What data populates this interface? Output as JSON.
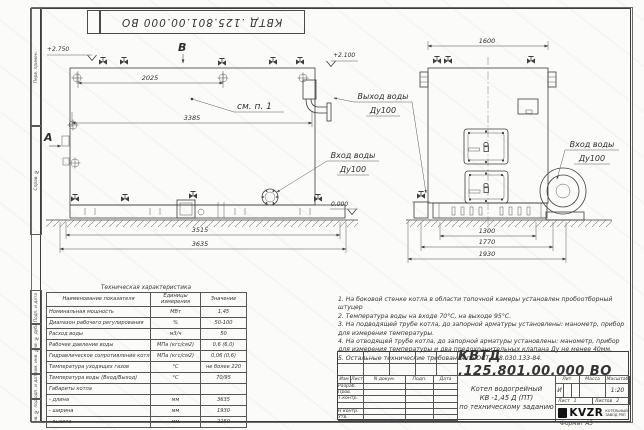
{
  "colors": {
    "line": "#3d3d3d",
    "paper": "#fbfbf9"
  },
  "stamp": {
    "doc_number_rotated": "КВТД .125.801.00.000  ВО"
  },
  "frame": {
    "side_labels": [
      "Перв. примен.",
      "Справ. №",
      "Подп. и дата",
      "Инв. № дубл.",
      "Взам. инв. №",
      "Подп. и дата",
      "Инв. № подл."
    ],
    "format_note": "Формат   А3"
  },
  "drawing": {
    "dims": {
      "top_left": "2025",
      "body_left": "3385",
      "base_left": "3515",
      "overall_left": "3635",
      "top_right": "1600",
      "base_right": "1300",
      "mid_right": "1770",
      "overall_right": "1930"
    },
    "levels": {
      "top_left": "+2.750",
      "outlet": "+2.100",
      "ground": "0.000"
    },
    "views": {
      "a": "А",
      "b": "В"
    },
    "callouts": {
      "see_note": "см. п. 1",
      "outlet_line1": "Выход воды",
      "outlet_line2": "Ду100",
      "inlet_line1": "Вход воды",
      "inlet_line2": "Ду100",
      "inlet_right_line1": "Вход воды",
      "inlet_right_line2": "Ду100"
    }
  },
  "tech_table": {
    "title": "Техническая характеристика",
    "headers": [
      "Наименование показателя",
      "Единицы измерения",
      "Значение"
    ],
    "rows": [
      [
        "Номинальная мощность",
        "МВт",
        "1,45"
      ],
      [
        "Диапазон рабочего регулирования",
        "%",
        "50-100"
      ],
      [
        "Расход воды",
        "м3/ч",
        "50"
      ],
      [
        "Рабочее давление воды",
        "МПа (кгс/см2)",
        "0,6 (6,0)"
      ],
      [
        "Гидравлическое сопротивление котла",
        "МПа (кгс/см2)",
        "0,06 (0,6)"
      ],
      [
        "Температура уходящих газов",
        "°С",
        "не более 220"
      ],
      [
        "Температура воды (Вход/Выход)",
        "°С",
        "70/95"
      ],
      [
        "Габариты котла",
        "",
        ""
      ],
      [
        "   - длина",
        "мм",
        "3635"
      ],
      [
        "   - ширина",
        "мм",
        "1930"
      ],
      [
        "   - высота",
        "мм",
        "2250"
      ]
    ]
  },
  "notes": {
    "items": [
      "1.  На боковой стенке котла в области топочной камеры установлен пробоотборный штуцер",
      "2.  Температура воды на входе 70°С, на выходе 95°С.",
      "3.  На подводящей трубе котла, до запорной арматуры установлены: манометр, прибор для измерения температуры.",
      "4.  На отводящей трубе котла, до запорной арматуры установлены: манометр, прибор для измерения температуры и два предохранительных клапана Ду не менее 40мм.",
      "5.  Остальные технические требования по ОСТ 108.030.133-84."
    ]
  },
  "title_block": {
    "doc_number": "КВТД .125.801.00.000  ВО",
    "columns": {
      "izm": "Изм",
      "list": "Лист",
      "ndoc": "N докум.",
      "podp": "Подп.",
      "data": "Дата"
    },
    "roles": {
      "r1": "Разраб.",
      "r2": "Пров.",
      "r3": "Т.контр.",
      "r4": "",
      "r5": "Н.контр.",
      "r6": "Утв."
    },
    "product": {
      "line1": "Котел водогрейный",
      "line2": "КВ -1,45  Д  (ПТ)",
      "line3": "по техническому заданию"
    },
    "grid": {
      "lit_label": "Лит.",
      "mass_label": "Масса",
      "scale_label": "Масштаб",
      "lit": "И",
      "mass": "",
      "scale": "1:20",
      "sheet_label": "Лист",
      "sheet": "1",
      "sheets_label": "Листов",
      "sheets": "2"
    },
    "logo": {
      "name": "KVZR",
      "sub1": "КОТЕЛЬНЫЙ",
      "sub2": "ЗАВОД РЭП"
    }
  }
}
